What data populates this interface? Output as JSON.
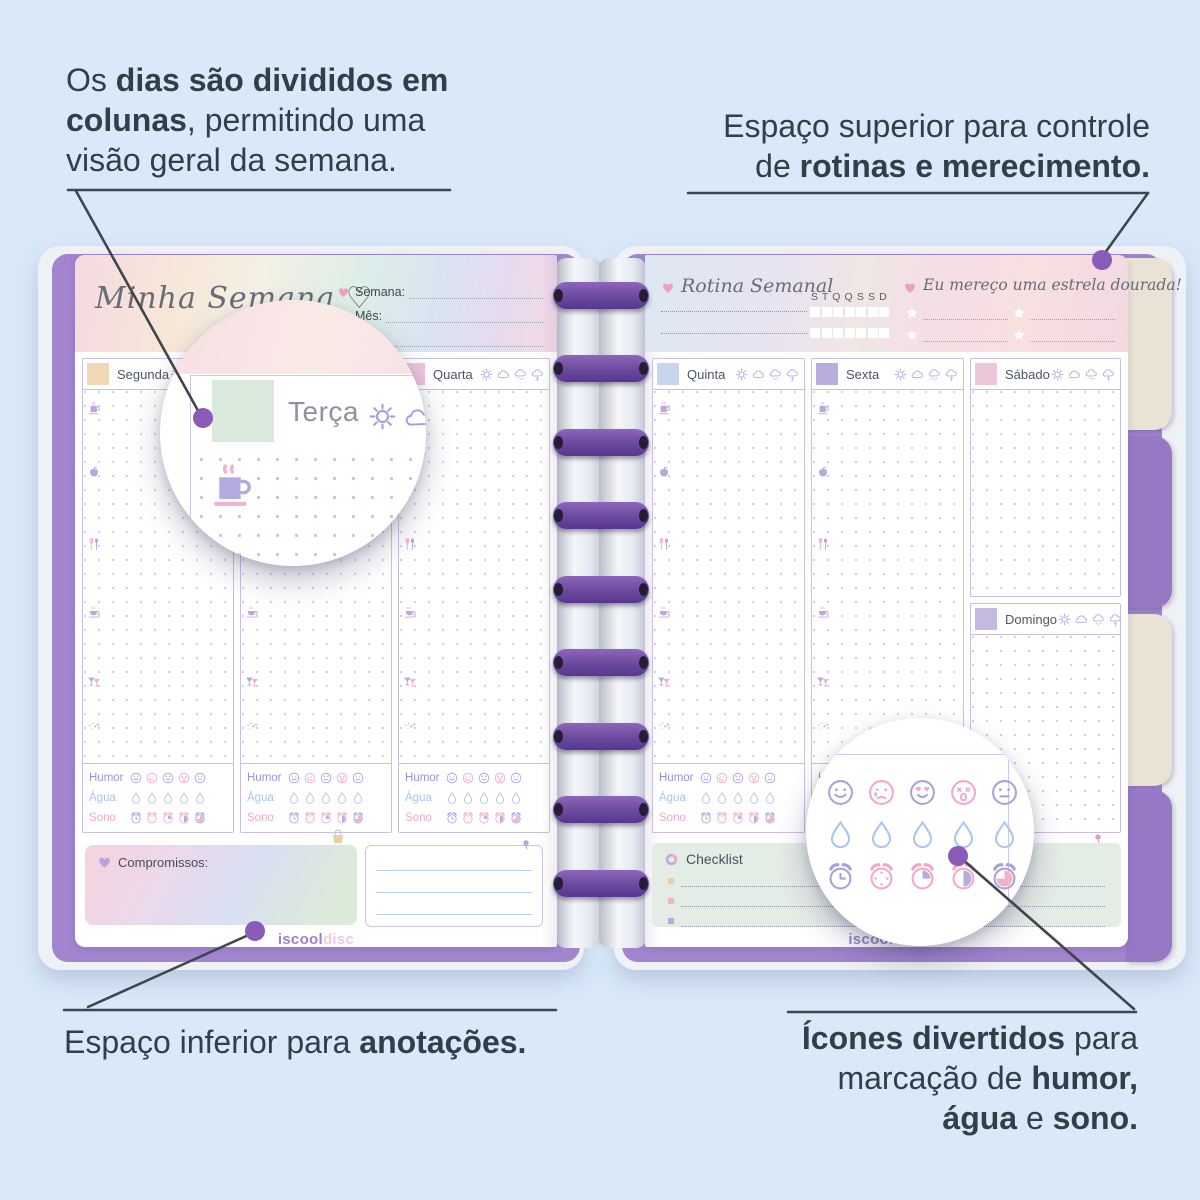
{
  "annotations": {
    "top_left": {
      "l1a": "Os ",
      "l1b": "dias são divididos em",
      "l2b": "colunas",
      "l2a": ", permitindo uma",
      "l3": "visão geral da semana."
    },
    "top_right": {
      "l1": "Espaço superior para controle",
      "l2a": "de ",
      "l2b": "rotinas e merecimento."
    },
    "bottom_left": {
      "a": "Espaço inferior para ",
      "b": "anotações."
    },
    "bottom_right": {
      "l1b": "Ícones divertidos",
      "l1a": " para",
      "l2a": "marcação de ",
      "l2b": "humor,",
      "l3a": "água",
      "l3b": " e ",
      "l3c": "sono."
    }
  },
  "planner": {
    "left_page": {
      "title": "Minha Semana ♡",
      "fields": {
        "f1": "Semana:",
        "f2": "Mês:",
        "f3": "Ano:"
      },
      "days": {
        "d1": "Segunda",
        "d2": "Terça",
        "d3": "Quarta"
      },
      "day_styles": {
        "d1": "background:#f0d8b6",
        "d2": "background:#d9e8da",
        "d3": "background:#edc5da"
      },
      "tracker": {
        "humor": "Humor",
        "agua": "Água",
        "sono": "Sono"
      },
      "commitments_label": "Compromissos:",
      "logo_part1": "iscool",
      "logo_part2": "disc"
    },
    "right_page": {
      "routine_title": "Rotina Semanal",
      "week_letters": "S T Q Q S S D",
      "star_title": "Eu mereço uma estrela dourada!",
      "days": {
        "d4": "Quinta",
        "d5": "Sexta",
        "d6": "Sábado",
        "d7": "Domingo"
      },
      "day_styles": {
        "d4": "background:#c7d6ee",
        "d5": "background:#b9addd",
        "d6": "background:#eec6da",
        "d7": "background:#c4badf"
      },
      "tracker": {
        "humor": "Humor",
        "agua": "Água",
        "sono": "Sono"
      },
      "checklist_label": "Checklist",
      "logo_part1": "iscool",
      "logo_part2": "disc"
    },
    "magnifier_day_label": "Terça",
    "colors": {
      "background": "#d9e9fa",
      "cover_purple": "#a284cf",
      "disc_purple": "#6b4a9e",
      "callout_dot": "#8a5cb8",
      "icon_purple": "#a9a2d8",
      "icon_pink": "#f2a9c9",
      "icon_blue": "#abc7ea",
      "tab_beige": "#eae2d4",
      "tab_purple": "#9678c5"
    }
  }
}
